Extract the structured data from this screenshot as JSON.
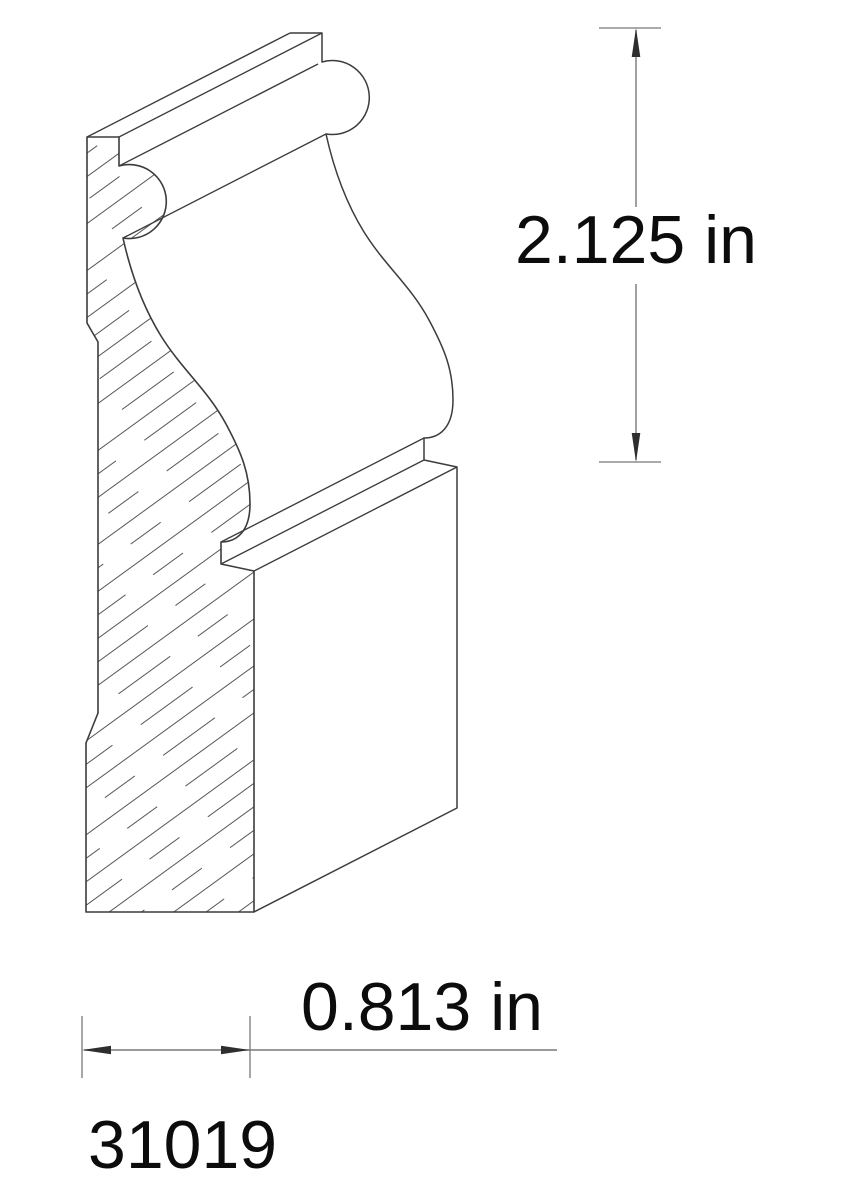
{
  "colors": {
    "background": "#ffffff",
    "outline": "#3c3c3c",
    "hatchline": "#565656",
    "dimline": "#787878",
    "arrowhead": "#2e2e2e",
    "textcolor": "#0c0c0c"
  },
  "drawing": {
    "part_number": "31019",
    "height_dimension": "2.125 in",
    "width_dimension": "0.813 in",
    "units": "in"
  }
}
